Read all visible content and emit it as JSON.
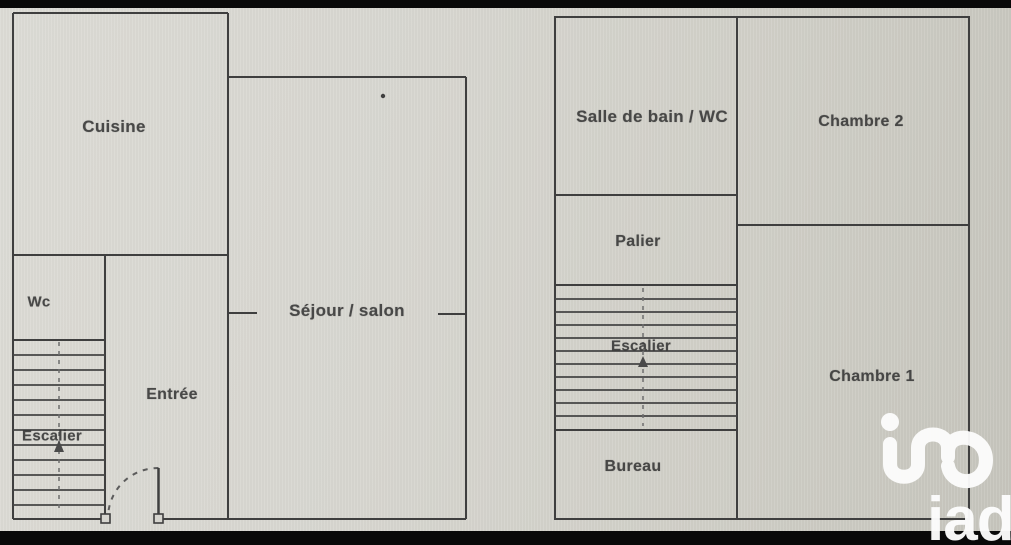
{
  "floorplan": {
    "ground_floor": {
      "labels": {
        "cuisine": "Cuisine",
        "sejour": "Séjour / salon",
        "wc": "Wc",
        "escalier": "Escalier",
        "entree": "Entrée"
      }
    },
    "upper_floor": {
      "labels": {
        "salle_de_bain": "Salle de bain / WC",
        "chambre2": "Chambre 2",
        "palier": "Palier",
        "escalier": "Escalier",
        "chambre1": "Chambre 1",
        "bureau": "Bureau"
      }
    },
    "colors": {
      "background": "#d6d5cf",
      "wall": "#3f3f3f",
      "label_text": "#353535",
      "letterbox_bar": "#090909",
      "watermark": "#fdfdfd"
    }
  },
  "watermark": {
    "brand": "iad"
  }
}
